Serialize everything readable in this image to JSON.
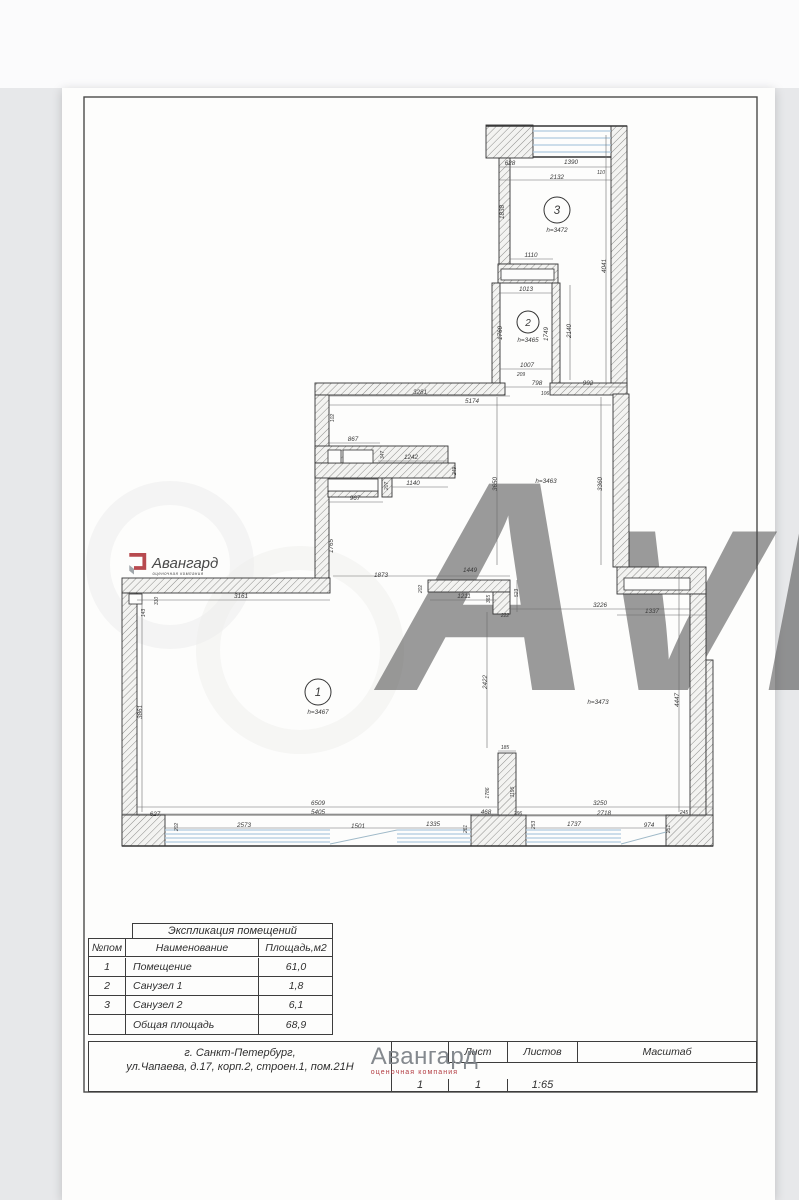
{
  "colors": {
    "accent_red": "#b23b41",
    "logo_gray": "#84898e",
    "window_blue": "#aecade",
    "ink": "#3a3a3a"
  },
  "watermark": {
    "site_text": "Avito"
  },
  "logo": {
    "name": "Авангард",
    "tagline": "оценочная компания"
  },
  "plan": {
    "rooms": [
      {
        "num": "1",
        "height_label": "h=3467",
        "cx": 318,
        "cy": 692,
        "r": 13
      },
      {
        "num": "2",
        "height_label": "h=3465",
        "cx": 528,
        "cy": 322,
        "r": 11
      },
      {
        "num": "3",
        "height_label": "h=3472",
        "cx": 557,
        "cy": 210,
        "r": 13
      }
    ],
    "height_labels": [
      {
        "t": "h=3463",
        "x": 546,
        "y": 483
      },
      {
        "t": "h=3473",
        "x": 598,
        "y": 704
      }
    ],
    "dim_labels": [
      {
        "t": "628",
        "x": 510,
        "y": 165
      },
      {
        "t": "1390",
        "x": 571,
        "y": 164
      },
      {
        "t": "110",
        "x": 601,
        "y": 174,
        "s": 5
      },
      {
        "t": "2132",
        "x": 557,
        "y": 179
      },
      {
        "t": "1838",
        "x": 504,
        "y": 212,
        "r": -90
      },
      {
        "t": "1110",
        "x": 531,
        "y": 257
      },
      {
        "t": "4041",
        "x": 606,
        "y": 266,
        "r": -90
      },
      {
        "t": "1013",
        "x": 526,
        "y": 291
      },
      {
        "t": "1760",
        "x": 502,
        "y": 333,
        "r": -90
      },
      {
        "t": "1749",
        "x": 548,
        "y": 334,
        "r": -90
      },
      {
        "t": "2140",
        "x": 571,
        "y": 331,
        "r": -90
      },
      {
        "t": "1007",
        "x": 527,
        "y": 367
      },
      {
        "t": "209",
        "x": 521,
        "y": 376,
        "s": 5
      },
      {
        "t": "798",
        "x": 537,
        "y": 385
      },
      {
        "t": "992",
        "x": 588,
        "y": 385
      },
      {
        "t": "106",
        "x": 545,
        "y": 395,
        "s": 5
      },
      {
        "t": "3281",
        "x": 420,
        "y": 394
      },
      {
        "t": "5174",
        "x": 472,
        "y": 403
      },
      {
        "t": "102",
        "x": 334,
        "y": 418,
        "r": -90,
        "s": 5
      },
      {
        "t": "867",
        "x": 353,
        "y": 441
      },
      {
        "t": "347",
        "x": 384,
        "y": 455,
        "r": -90,
        "s": 5
      },
      {
        "t": "1242",
        "x": 411,
        "y": 459
      },
      {
        "t": "249",
        "x": 456,
        "y": 471,
        "r": -90,
        "s": 5
      },
      {
        "t": "1140",
        "x": 413,
        "y": 485
      },
      {
        "t": "207",
        "x": 388,
        "y": 486,
        "r": -90,
        "s": 5
      },
      {
        "t": "967",
        "x": 355,
        "y": 500
      },
      {
        "t": "3650",
        "x": 497,
        "y": 484,
        "r": -90
      },
      {
        "t": "3360",
        "x": 602,
        "y": 484,
        "r": -90
      },
      {
        "t": "1765",
        "x": 333,
        "y": 546,
        "r": -90
      },
      {
        "t": "1873",
        "x": 381,
        "y": 577
      },
      {
        "t": "1449",
        "x": 470,
        "y": 572
      },
      {
        "t": "202",
        "x": 422,
        "y": 589,
        "r": -90,
        "s": 5
      },
      {
        "t": "1211",
        "x": 464,
        "y": 598
      },
      {
        "t": "365",
        "x": 490,
        "y": 599,
        "r": -90,
        "s": 5
      },
      {
        "t": "523",
        "x": 518,
        "y": 593,
        "r": -90,
        "s": 5
      },
      {
        "t": "222",
        "x": 505,
        "y": 617,
        "s": 5
      },
      {
        "t": "3226",
        "x": 600,
        "y": 607
      },
      {
        "t": "1337",
        "x": 652,
        "y": 613
      },
      {
        "t": "3161",
        "x": 241,
        "y": 598
      },
      {
        "t": "310",
        "x": 158,
        "y": 601,
        "r": -90,
        "s": 5
      },
      {
        "t": "143",
        "x": 145,
        "y": 613,
        "r": -90,
        "s": 5
      },
      {
        "t": "3861",
        "x": 142,
        "y": 712,
        "r": -90
      },
      {
        "t": "2422",
        "x": 487,
        "y": 682,
        "r": -90
      },
      {
        "t": "185",
        "x": 505,
        "y": 749,
        "s": 5
      },
      {
        "t": "4447",
        "x": 679,
        "y": 700,
        "r": -90
      },
      {
        "t": "6509",
        "x": 318,
        "y": 805
      },
      {
        "t": "5405",
        "x": 318,
        "y": 814
      },
      {
        "t": "627",
        "x": 155,
        "y": 816
      },
      {
        "t": "202",
        "x": 178,
        "y": 827,
        "r": -90,
        "s": 5
      },
      {
        "t": "2573",
        "x": 244,
        "y": 827
      },
      {
        "t": "1501",
        "x": 358,
        "y": 828
      },
      {
        "t": "1335",
        "x": 433,
        "y": 826
      },
      {
        "t": "1786",
        "x": 489,
        "y": 793,
        "r": -90,
        "s": 5
      },
      {
        "t": "1195",
        "x": 514,
        "y": 792,
        "r": -90,
        "s": 5
      },
      {
        "t": "468",
        "x": 486,
        "y": 814
      },
      {
        "t": "296",
        "x": 518,
        "y": 815,
        "s": 5
      },
      {
        "t": "261",
        "x": 467,
        "y": 829,
        "r": -90,
        "s": 5
      },
      {
        "t": "253",
        "x": 535,
        "y": 825,
        "r": -90,
        "s": 5
      },
      {
        "t": "3250",
        "x": 600,
        "y": 805
      },
      {
        "t": "2718",
        "x": 604,
        "y": 815
      },
      {
        "t": "1737",
        "x": 574,
        "y": 826
      },
      {
        "t": "974",
        "x": 649,
        "y": 827
      },
      {
        "t": "245",
        "x": 684,
        "y": 814,
        "s": 5
      },
      {
        "t": "251",
        "x": 670,
        "y": 829,
        "r": -90,
        "s": 5
      }
    ]
  },
  "table": {
    "caption": "Экспликация помещений",
    "columns": [
      "№пом",
      "Наименование",
      "Площадь,м2"
    ],
    "rows": [
      [
        "1",
        "Помещение",
        "61,0"
      ],
      [
        "2",
        "Санузел 1",
        "1,8"
      ],
      [
        "3",
        "Санузел 2",
        "6,1"
      ],
      [
        "",
        "Общая площадь",
        "68,9"
      ]
    ]
  },
  "title_block": {
    "address_line1": "г. Санкт-Петербург,",
    "address_line2": "ул.Чапаева, д.17, корп.2, строен.1, пом.21Н",
    "sheet_label": "Лист",
    "sheet_value": "1",
    "sheets_label": "Листов",
    "sheets_value": "1",
    "scale_label": "Масштаб",
    "scale_value": "1:65"
  }
}
